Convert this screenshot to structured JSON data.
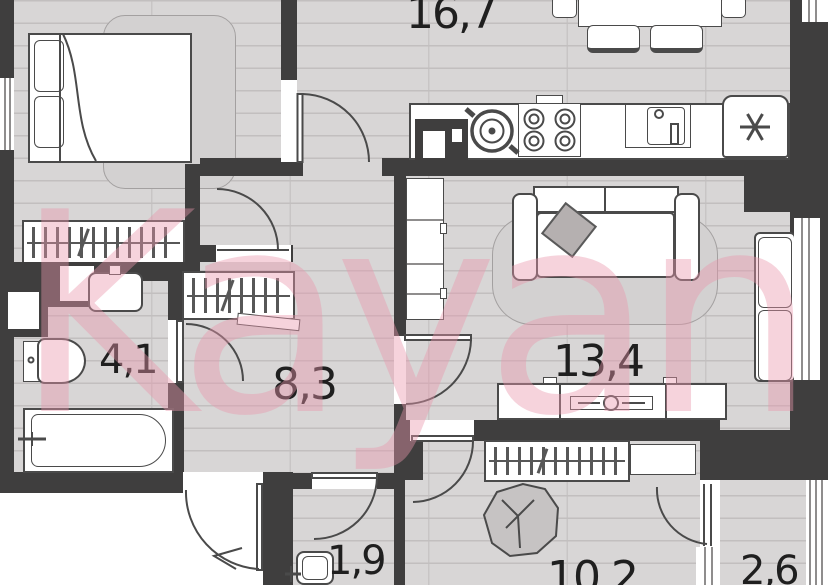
{
  "watermark": {
    "text": "Kayan",
    "color": "#e796ac"
  },
  "rooms": [
    {
      "name": "kitchen-living-room",
      "area_label": "16,7"
    },
    {
      "name": "bathroom",
      "area_label": "4,1"
    },
    {
      "name": "hallway",
      "area_label": "8,3"
    },
    {
      "name": "lounge",
      "area_label": "13,4"
    },
    {
      "name": "water-closet",
      "area_label": "1,9"
    },
    {
      "name": "bedroom",
      "area_label": "10,2"
    },
    {
      "name": "balcony",
      "area_label": "2,6"
    }
  ],
  "palette": {
    "wall": "#3f3e3e",
    "floor": "#d8d6d6",
    "floor_line": "#c2bfbf",
    "fixture_outline": "#4a4a4a",
    "label_text": "#1f1f1f",
    "watermark_pink": "#e796ac"
  },
  "symbols": {
    "fridge": "six-spoke-asterisk"
  }
}
